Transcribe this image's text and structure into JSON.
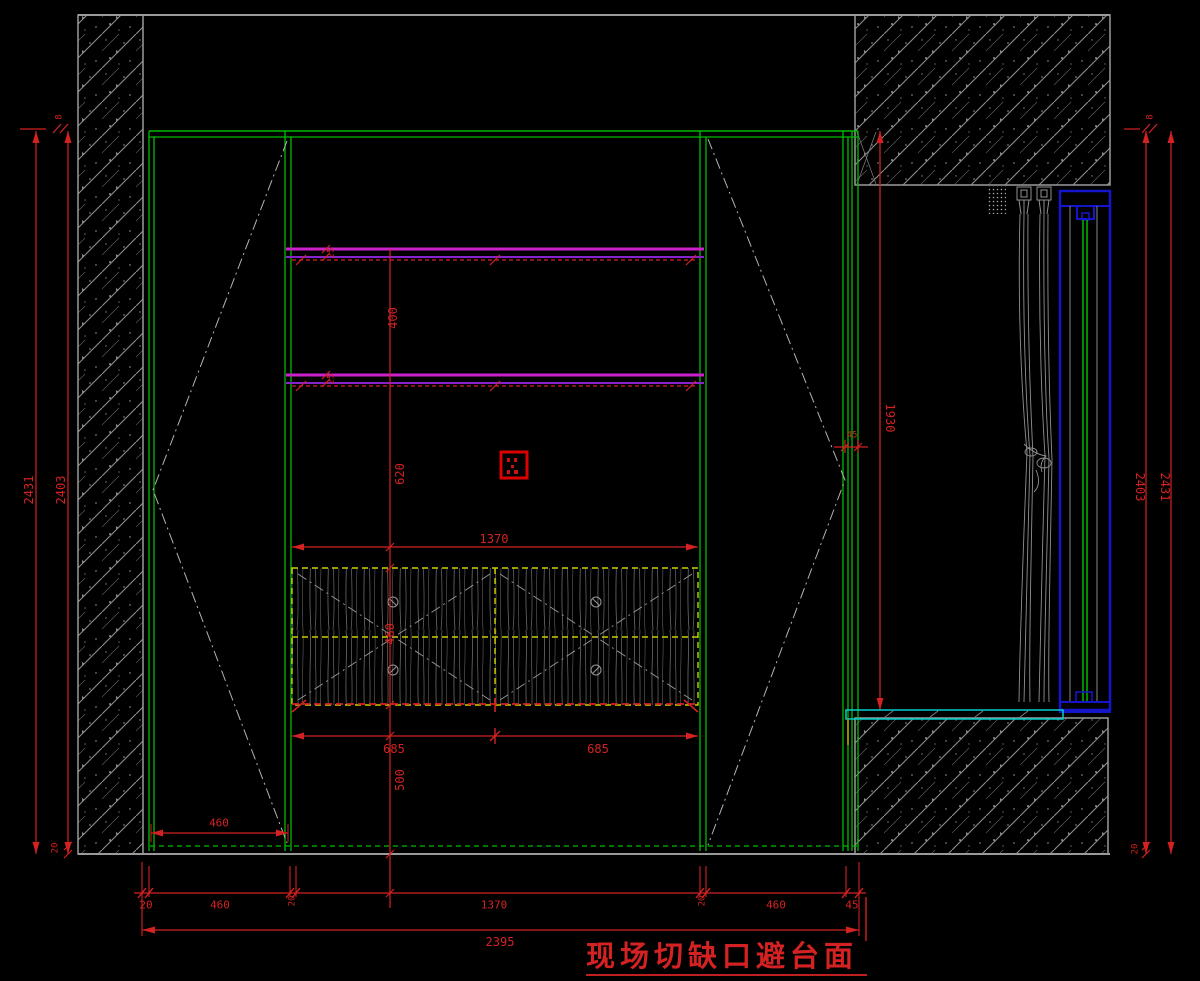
{
  "drawing": {
    "note": "现场切缺口避台面",
    "colors": {
      "cabinet_green": "#00bb00",
      "shelf_magenta": "#cc22cc",
      "shelf_purple": "#8822cc",
      "drawer_yellow": "#cccc00",
      "window_blue": "#1515cc",
      "counter_cyan": "#00cfcf",
      "dimension_red": "#d42222",
      "structure_gray": "#9a9a9a"
    },
    "dimensions": {
      "left": {
        "overall": "2431",
        "inner": "2403",
        "top_gap": "8",
        "bottom_gap": "20"
      },
      "right": {
        "overall": "2431",
        "inner": "2403",
        "top_gap": "8",
        "bottom_gap": "20",
        "frame_height": "1930"
      },
      "vertical_interior": {
        "shelf_thickness_top": "25",
        "shelf_thickness_bottom": "25",
        "shelf_spacing": "400",
        "shelf_to_counter": "620",
        "drawer_height": "460",
        "base_height": "500"
      },
      "horizontal_interior": {
        "opening_width": "1370",
        "drawer_left": "685",
        "drawer_right": "685",
        "door_width": "460",
        "notch_width": "45"
      },
      "bottom_row": [
        "20",
        "460",
        "20",
        "1370",
        "20",
        "460",
        "45"
      ],
      "total_width": "2395"
    }
  }
}
